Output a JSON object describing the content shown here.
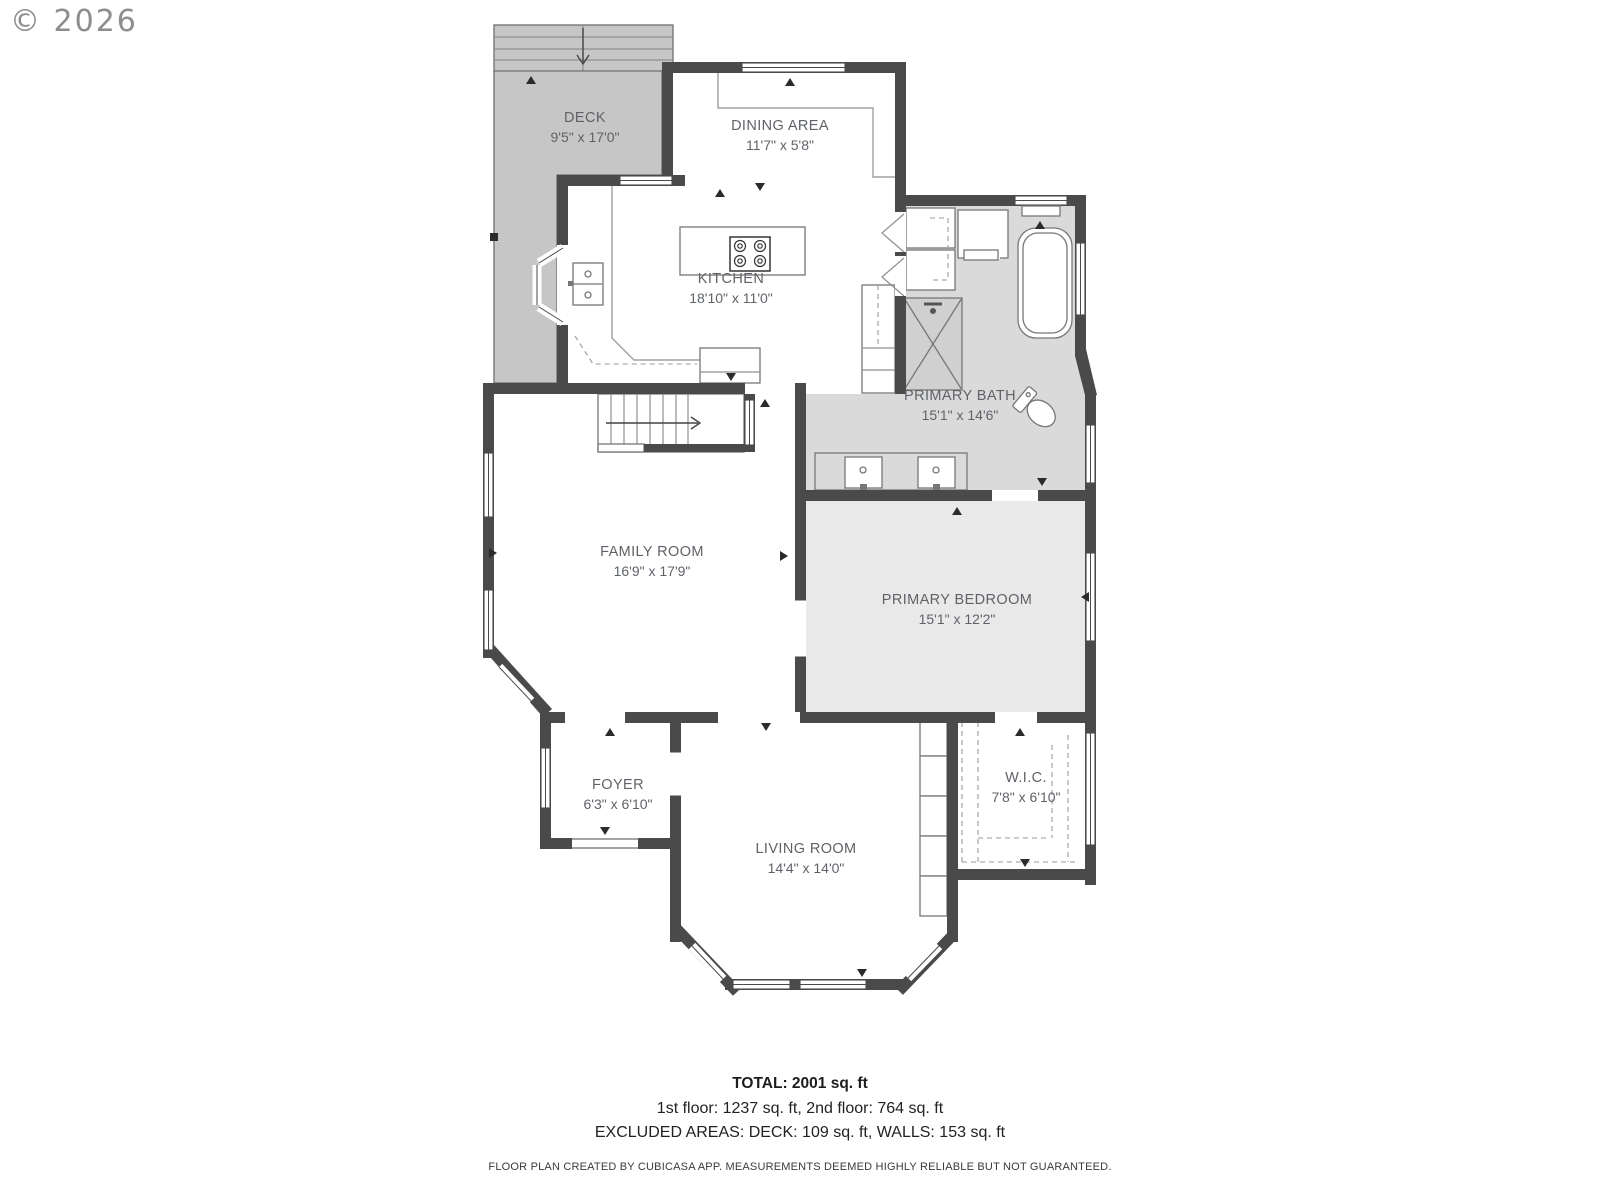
{
  "copyright": "© 2026",
  "rooms": {
    "deck": {
      "name": "DECK",
      "dims": "9'5\" x 17'0\""
    },
    "dining": {
      "name": "DINING AREA",
      "dims": "11'7\" x 5'8\""
    },
    "kitchen": {
      "name": "KITCHEN",
      "dims": "18'10\" x 11'0\""
    },
    "bath": {
      "name": "PRIMARY BATH",
      "dims": "15'1\" x 14'6\""
    },
    "family": {
      "name": "FAMILY ROOM",
      "dims": "16'9\" x 17'9\""
    },
    "bedroom": {
      "name": "PRIMARY BEDROOM",
      "dims": "15'1\" x 12'2\""
    },
    "foyer": {
      "name": "FOYER",
      "dims": "6'3\" x 6'10\""
    },
    "living": {
      "name": "LIVING ROOM",
      "dims": "14'4\" x 14'0\""
    },
    "wic": {
      "name": "W.I.C.",
      "dims": "7'8\" x 6'10\""
    }
  },
  "summary": {
    "total": "TOTAL: 2001 sq. ft",
    "floors": "1st floor: 1237 sq. ft, 2nd floor: 764 sq. ft",
    "excluded": "EXCLUDED AREAS: DECK: 109 sq. ft, WALLS: 153 sq. ft"
  },
  "disclaimer": "FLOOR PLAN CREATED BY CUBICASA APP. MEASUREMENTS DEEMED HIGHLY RELIABLE BUT NOT GUARANTEED.",
  "colors": {
    "wall": "#4a4a4a",
    "deck_fill": "#c6c6c6",
    "bath_fill": "#dadada",
    "bedroom_fill": "#e9e9e9",
    "label_text": "#5f6368"
  }
}
